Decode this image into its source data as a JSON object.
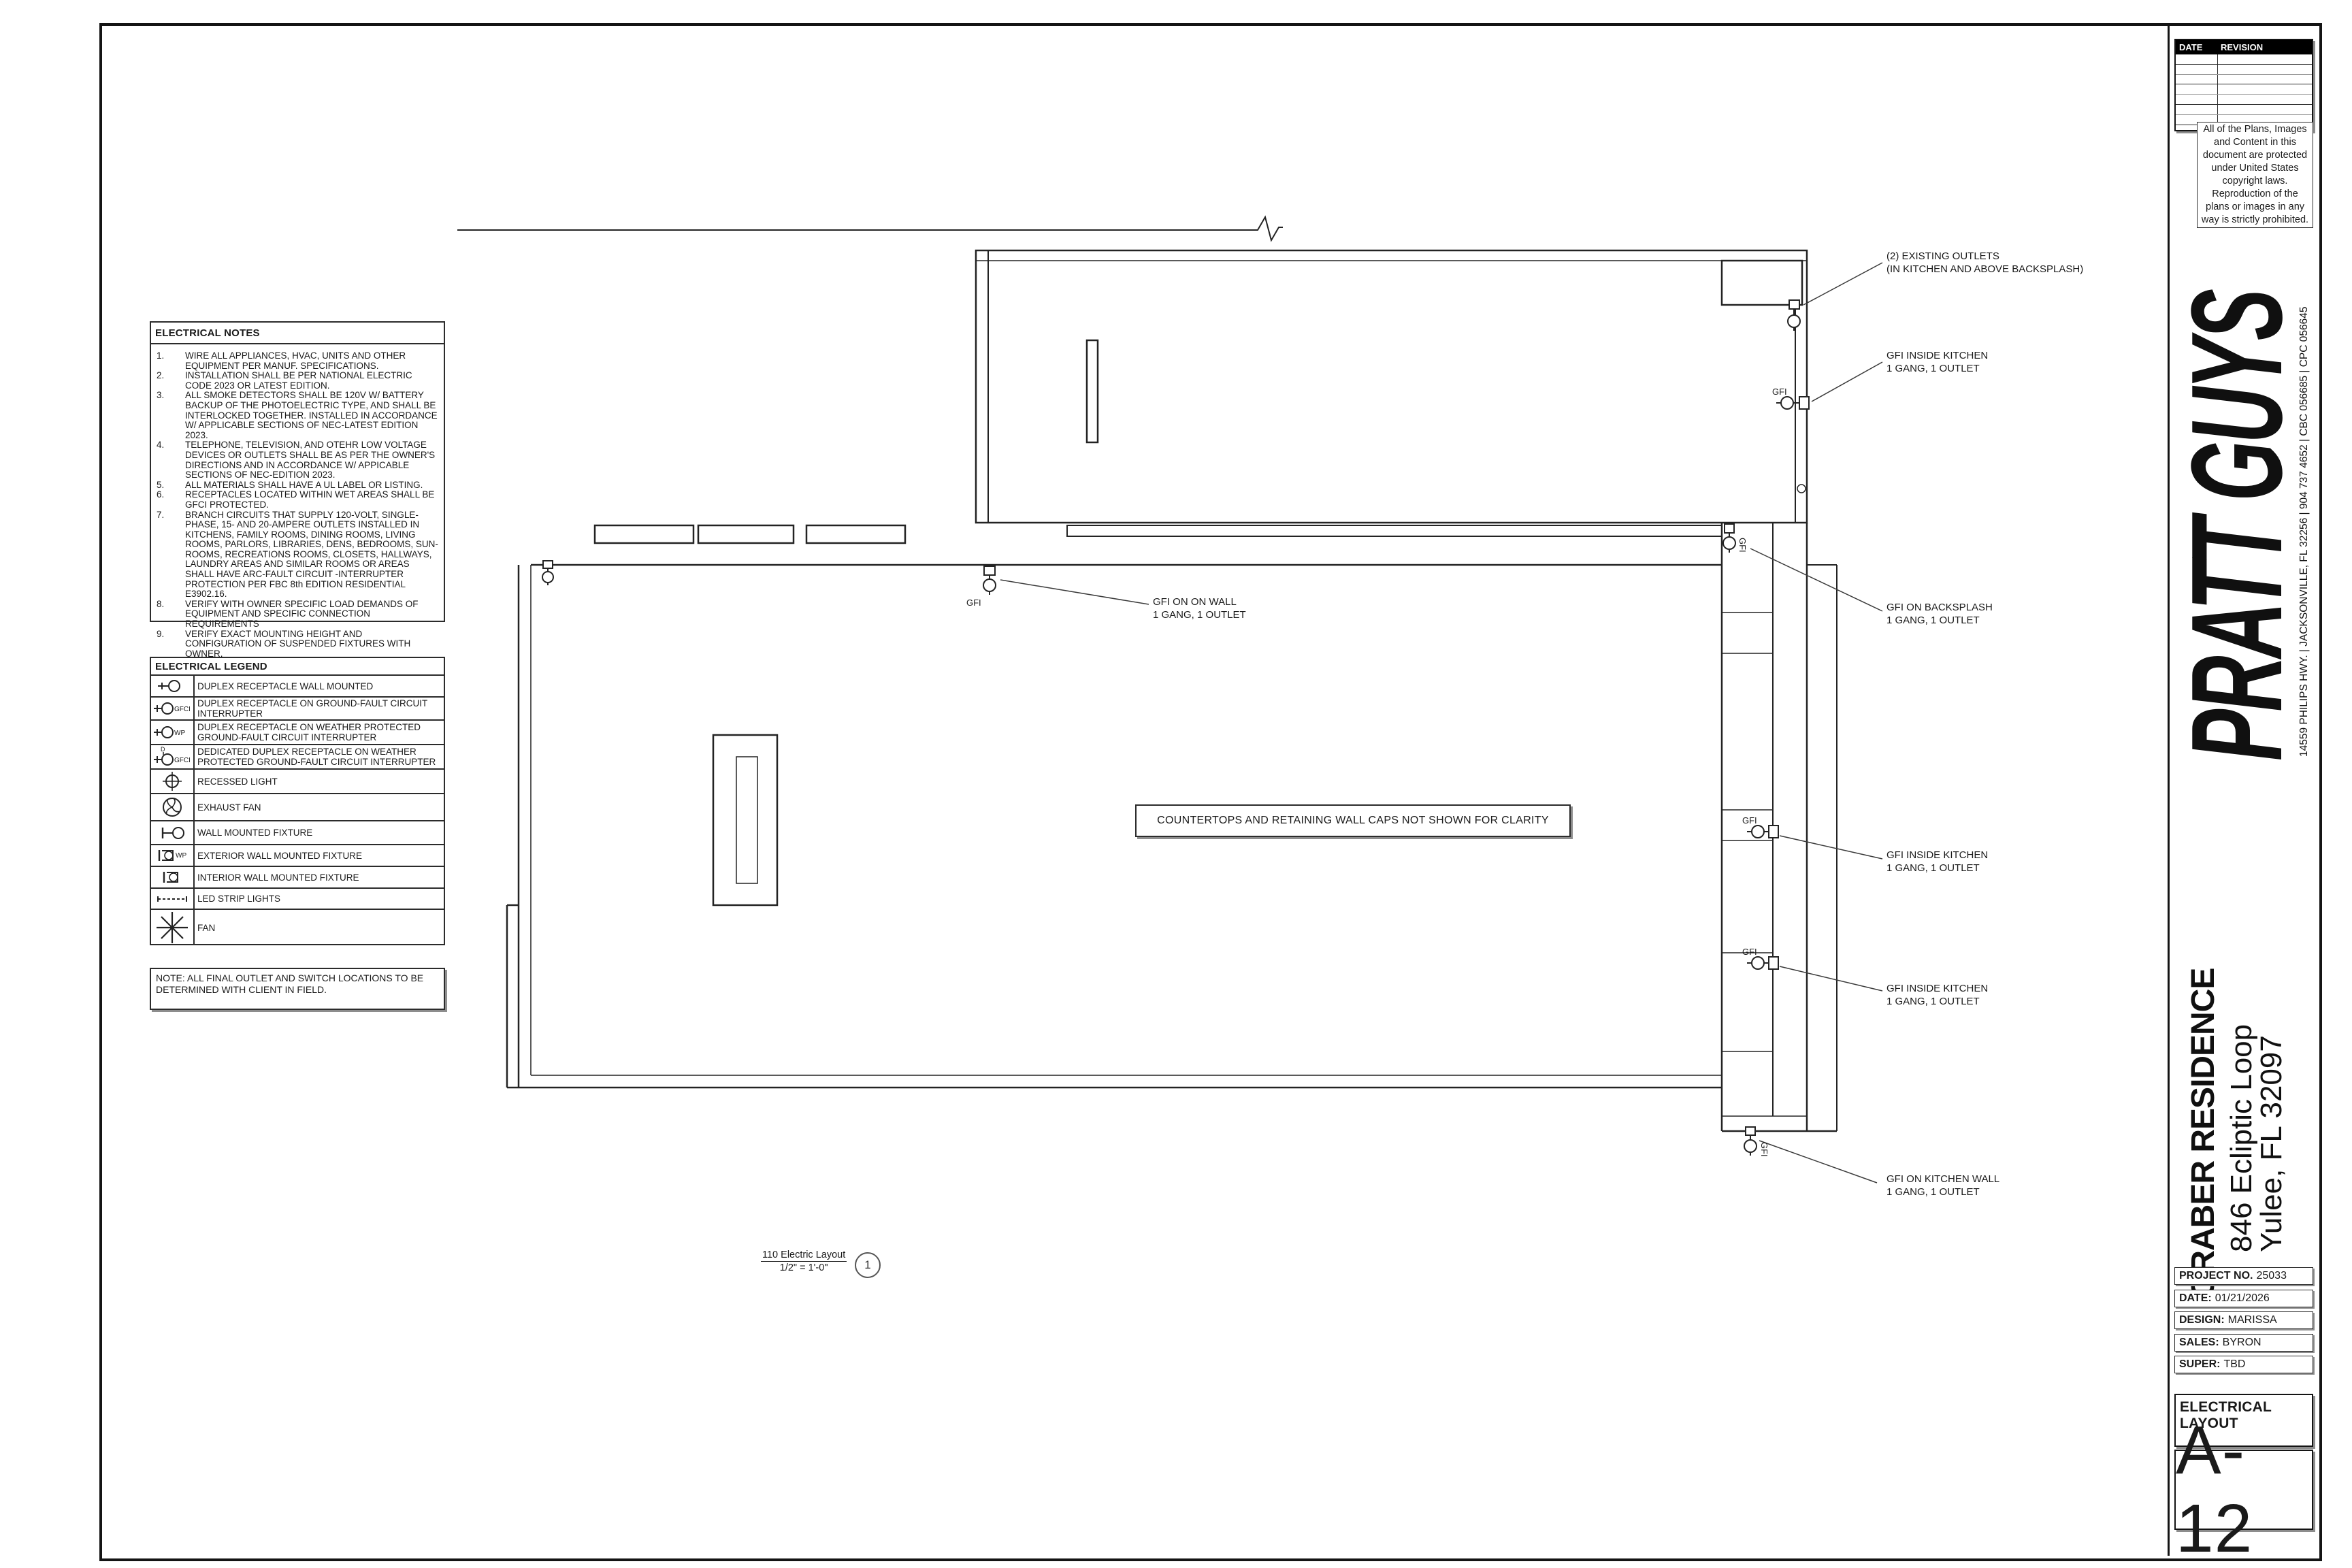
{
  "plan": {
    "gfi_label": "GFI",
    "clarity_note": "COUNTERTOPS  AND RETAINING WALL CAPS NOT SHOWN FOR CLARITY",
    "drawing_label": {
      "name": "110 Electric Layout",
      "scale": "1/2\" = 1'-0\"",
      "number": "1"
    },
    "callouts": [
      {
        "line1": "(2) EXISTING OUTLETS",
        "line2": "(IN KITCHEN AND ABOVE BACKSPLASH)"
      },
      {
        "line1": "GFI INSIDE KITCHEN",
        "line2": "1 GANG, 1 OUTLET"
      },
      {
        "line1": "GFI ON BACKSPLASH",
        "line2": "1 GANG, 1 OUTLET"
      },
      {
        "line1": "GFI ON ON WALL",
        "line2": "1 GANG, 1 OUTLET"
      },
      {
        "line1": "GFI INSIDE KITCHEN",
        "line2": "1 GANG, 1 OUTLET"
      },
      {
        "line1": "GFI INSIDE KITCHEN",
        "line2": "1 GANG, 1 OUTLET"
      },
      {
        "line1": "GFI ON KITCHEN WALL",
        "line2": "1 GANG, 1 OUTLET"
      }
    ]
  },
  "electrical_notes": {
    "title": "ELECTRICAL NOTES",
    "items": [
      {
        "num": "1.",
        "text": "WIRE ALL APPLIANCES, HVAC, UNITS AND OTHER EQUIPMENT PER MANUF. SPECIFICATIONS."
      },
      {
        "num": "2.",
        "text": "INSTALLATION SHALL BE PER NATIONAL ELECTRIC CODE 2023 OR LATEST EDITION."
      },
      {
        "num": "3.",
        "text": "ALL SMOKE DETECTORS SHALL BE 120V W/ BATTERY BACKUP OF THE PHOTOELECTRIC TYPE, AND SHALL BE INTERLOCKED TOGETHER. INSTALLED IN ACCORDANCE W/ APPLICABLE SECTIONS OF NEC-LATEST EDITION 2023."
      },
      {
        "num": "4.",
        "text": "TELEPHONE, TELEVISION, AND OTEHR LOW VOLTAGE DEVICES OR OUTLETS SHALL BE AS PER THE OWNER'S DIRECTIONS AND IN ACCORDANCE W/ APPICABLE SECTIONS OF NEC-EDITION 2023."
      },
      {
        "num": "5.",
        "text": "ALL MATERIALS SHALL HAVE A UL LABEL OR LISTING."
      },
      {
        "num": "6.",
        "text": "RECEPTACLES LOCATED WITHIN WET AREAS SHALL BE GFCI PROTECTED."
      },
      {
        "num": "7.",
        "text": "BRANCH CIRCUITS THAT SUPPLY 120-VOLT, SINGLE-PHASE, 15- AND 20-AMPERE OUTLETS INSTALLED IN KITCHENS, FAMILY ROOMS, DINING ROOMS, LIVING ROOMS, PARLORS, LIBRARIES, DENS, BEDROOMS, SUN-ROOMS, RECREATIONS ROOMS, CLOSETS, HALLWAYS, LAUNDRY AREAS AND SIMILAR ROOMS OR AREAS SHALL HAVE ARC-FAULT CIRCUIT -INTERRUPTER PROTECTION PER FBC 8th EDITION RESIDENTIAL E3902.16."
      },
      {
        "num": "8.",
        "text": "VERIFY WITH OWNER SPECIFIC LOAD DEMANDS OF EQUIPMENT AND SPECIFIC CONNECTION REQUIREMENTS"
      },
      {
        "num": "9.",
        "text": "VERIFY EXACT MOUNTING HEIGHT AND CONFIGURATION OF SUSPENDED FIXTURES WITH OWNER."
      }
    ]
  },
  "electrical_legend": {
    "title": "ELECTRICAL LEGEND",
    "rows": [
      {
        "symbol": "duplex-receptacle",
        "tag": "",
        "label": "DUPLEX RECEPTACLE WALL MOUNTED"
      },
      {
        "symbol": "duplex-receptacle-gfci",
        "tag": "GFCI",
        "label": "DUPLEX RECEPTACLE ON GROUND-FAULT CIRCUIT INTERRUPTER"
      },
      {
        "symbol": "duplex-receptacle-wp",
        "tag": "WP",
        "label": "DUPLEX RECEPTACLE ON WEATHER PROTECTED GROUND-FAULT CIRCUIT INTERRUPTER"
      },
      {
        "symbol": "dedicated-duplex-receptacle-gfci",
        "tag": "GFCI",
        "tag2": "D",
        "label": "DEDICATED DUPLEX RECEPTACLE ON WEATHER PROTECTED GROUND-FAULT CIRCUIT INTERRUPTER"
      },
      {
        "symbol": "recessed-light",
        "tag": "",
        "label": "RECESSED LIGHT"
      },
      {
        "symbol": "exhaust-fan",
        "tag": "",
        "label": "EXHAUST FAN"
      },
      {
        "symbol": "wall-mounted-fixture",
        "tag": "",
        "label": "WALL MOUNTED FIXTURE"
      },
      {
        "symbol": "exterior-wall-mounted-fixture",
        "tag": "WP",
        "label": "EXTERIOR WALL MOUNTED FIXTURE"
      },
      {
        "symbol": "interior-wall-mounted-fixture",
        "tag": "",
        "label": "INTERIOR WALL MOUNTED FIXTURE"
      },
      {
        "symbol": "led-strip-lights",
        "tag": "",
        "label": "LED STRIP LIGHTS"
      },
      {
        "symbol": "fan",
        "tag": "",
        "label": "FAN"
      }
    ]
  },
  "field_note": "NOTE:  ALL FINAL OUTLET AND SWITCH LOCATIONS TO BE DETERMINED WITH CLIENT IN FIELD.",
  "title_block": {
    "revision_table": {
      "date_header": "DATE",
      "revision_header": "REVISION"
    },
    "copyright": "All of the Plans, Images and Content in this document are protected under United States copyright laws. Reproduction of the plans or images in any way is strictly prohibited.",
    "logo_text": "PRATT GUYS",
    "address_line": "14559 PHILIPS HWY. | JACKSONVILLE, FL 32256 | 904 737 4652 | CBC 056685 | CPC 056645",
    "residence": {
      "name": "GRABER RESIDENCE",
      "street": "846 Ecliptic Loop",
      "city": "Yulee, FL 32097"
    },
    "project_info": [
      {
        "label": "PROJECT NO.",
        "value": "25033"
      },
      {
        "label": "DATE:",
        "value": "01/21/2026"
      },
      {
        "label": "DESIGN:",
        "value": "MARISSA"
      },
      {
        "label": "SALES:",
        "value": "BYRON"
      },
      {
        "label": "SUPER:",
        "value": "TBD"
      }
    ],
    "sheet_title": "ELECTRICAL LAYOUT",
    "sheet_number": "A-12"
  }
}
